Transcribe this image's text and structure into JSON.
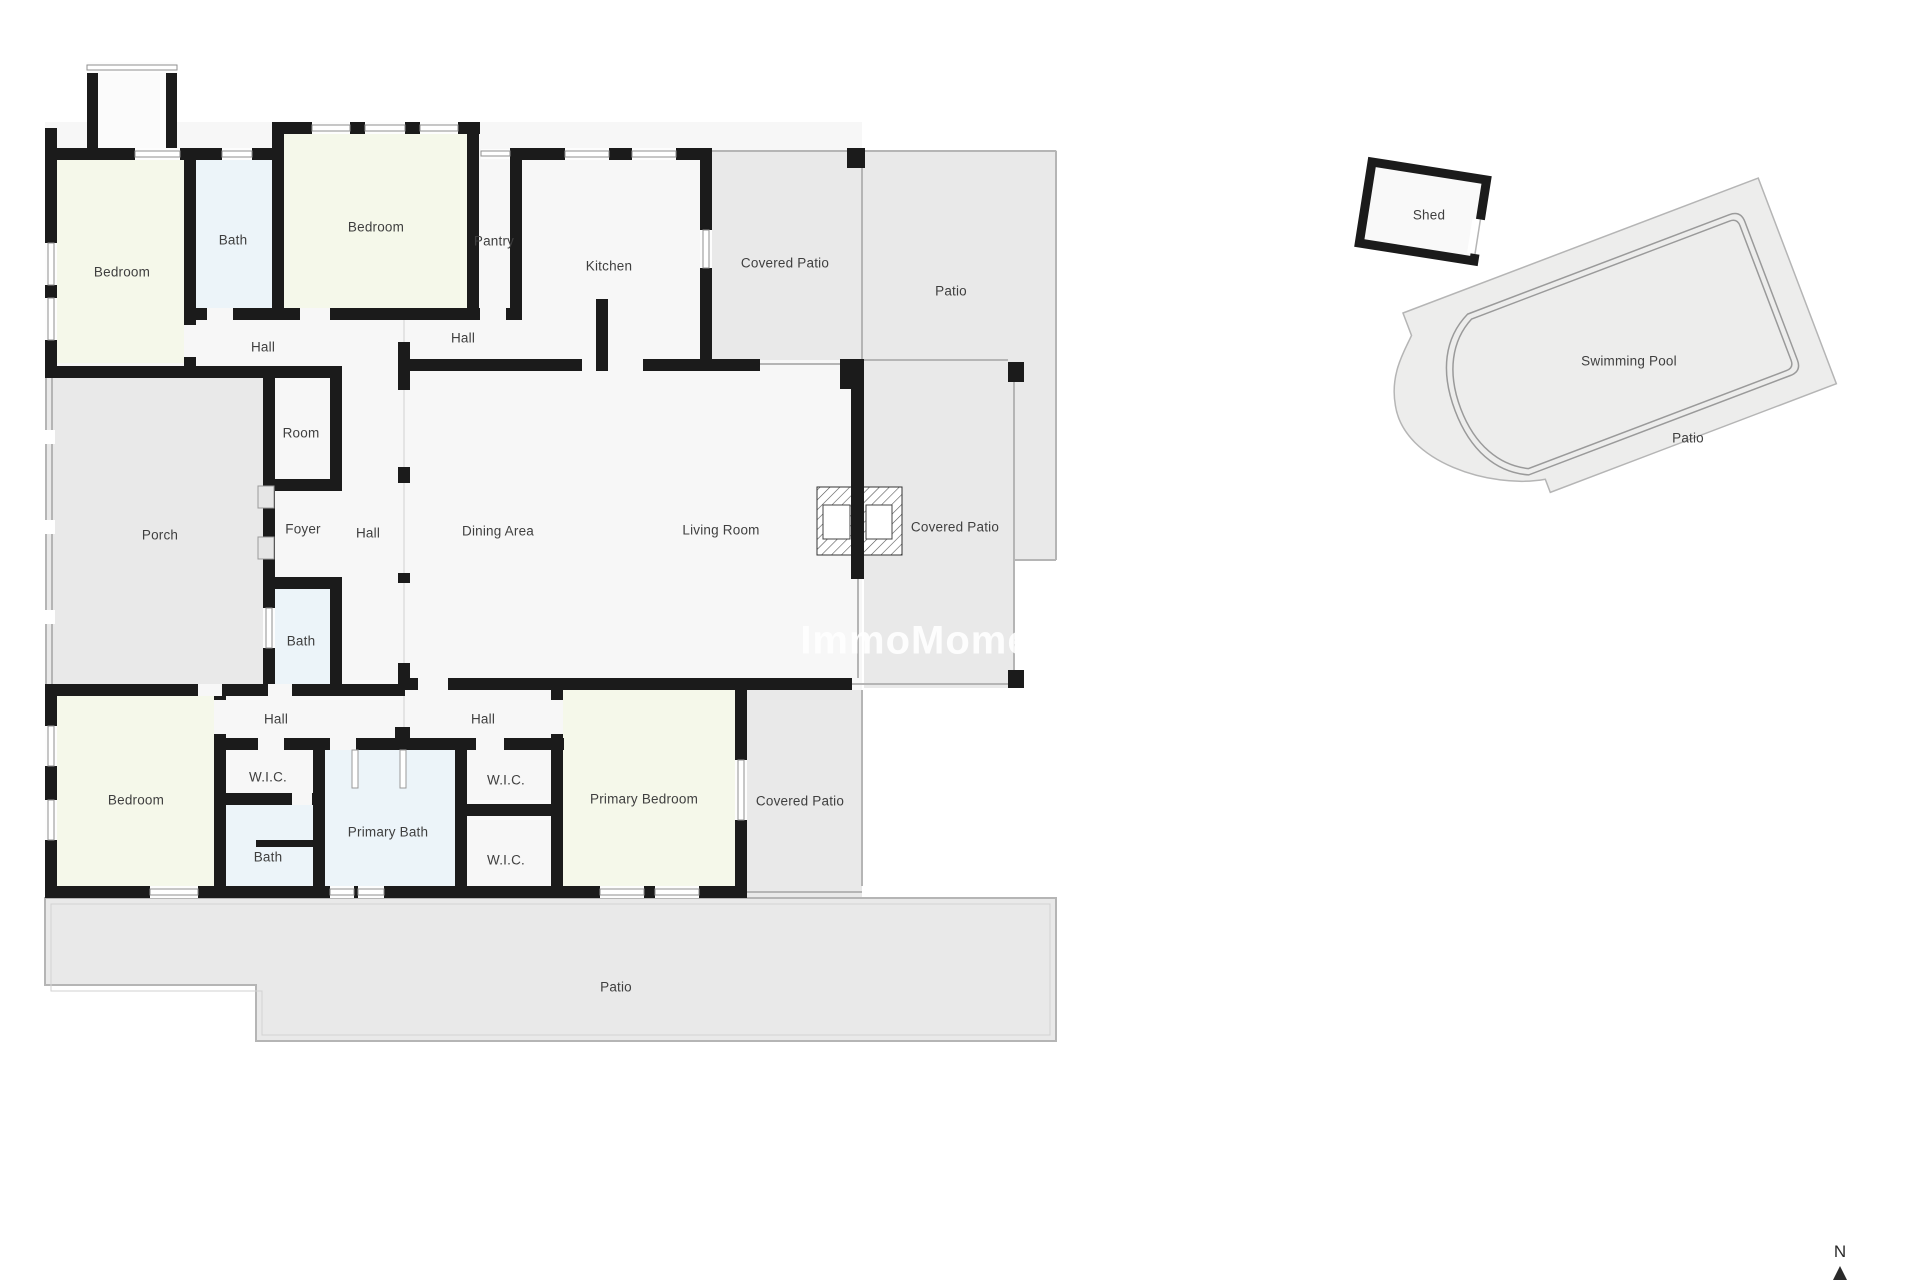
{
  "colors": {
    "wall": "#1b1b1b",
    "floor": "#f7f7f7",
    "patio": "#e9e9e9",
    "patio-light": "#ededec",
    "bedroom": "#f5f8ea",
    "bath": "#ecf4f9",
    "line": "#b5b5b5",
    "label": "#3f3f3f",
    "page-bg": "#ffffff"
  },
  "watermark": {
    "text": "ImmoMoment.e"
  },
  "compass": {
    "label": "N"
  },
  "floorplan": {
    "labels": [
      {
        "id": "bedroom-1",
        "text": "Bedroom",
        "x": 122,
        "y": 272
      },
      {
        "id": "bath-1",
        "text": "Bath",
        "x": 233,
        "y": 240
      },
      {
        "id": "bedroom-2",
        "text": "Bedroom",
        "x": 376,
        "y": 227
      },
      {
        "id": "pantry",
        "text": "Pantry",
        "x": 494,
        "y": 241
      },
      {
        "id": "kitchen",
        "text": "Kitchen",
        "x": 609,
        "y": 266
      },
      {
        "id": "covered-patio-top",
        "text": "Covered Patio",
        "x": 785,
        "y": 263
      },
      {
        "id": "patio-top",
        "text": "Patio",
        "x": 951,
        "y": 291
      },
      {
        "id": "hall-top-left",
        "text": "Hall",
        "x": 263,
        "y": 347
      },
      {
        "id": "hall-top-mid",
        "text": "Hall",
        "x": 463,
        "y": 338
      },
      {
        "id": "room",
        "text": "Room",
        "x": 301,
        "y": 433
      },
      {
        "id": "porch",
        "text": "Porch",
        "x": 160,
        "y": 535
      },
      {
        "id": "foyer",
        "text": "Foyer",
        "x": 303,
        "y": 529
      },
      {
        "id": "hall-center",
        "text": "Hall",
        "x": 368,
        "y": 533
      },
      {
        "id": "dining-area",
        "text": "Dining Area",
        "x": 498,
        "y": 531
      },
      {
        "id": "living-room",
        "text": "Living Room",
        "x": 721,
        "y": 530
      },
      {
        "id": "covered-patio-right",
        "text": "Covered Patio",
        "x": 955,
        "y": 527
      },
      {
        "id": "bath-center",
        "text": "Bath",
        "x": 301,
        "y": 641
      },
      {
        "id": "hall-bottom-left",
        "text": "Hall",
        "x": 276,
        "y": 719
      },
      {
        "id": "hall-bottom-mid",
        "text": "Hall",
        "x": 483,
        "y": 719
      },
      {
        "id": "bedroom-3",
        "text": "Bedroom",
        "x": 136,
        "y": 800
      },
      {
        "id": "wic-left",
        "text": "W.I.C.",
        "x": 268,
        "y": 777
      },
      {
        "id": "wic-mid-top",
        "text": "W.I.C.",
        "x": 506,
        "y": 780
      },
      {
        "id": "primary-bath",
        "text": "Primary Bath",
        "x": 388,
        "y": 832
      },
      {
        "id": "bath-bottom-left",
        "text": "Bath",
        "x": 268,
        "y": 857
      },
      {
        "id": "wic-mid-bottom",
        "text": "W.I.C.",
        "x": 506,
        "y": 860
      },
      {
        "id": "primary-bedroom",
        "text": "Primary Bedroom",
        "x": 644,
        "y": 799
      },
      {
        "id": "covered-patio-bottom",
        "text": "Covered Patio",
        "x": 800,
        "y": 801
      },
      {
        "id": "patio-bottom",
        "text": "Patio",
        "x": 616,
        "y": 987
      },
      {
        "id": "shed",
        "text": "Shed",
        "x": 1429,
        "y": 215
      },
      {
        "id": "swimming-pool",
        "text": "Swimming Pool",
        "x": 1629,
        "y": 361
      },
      {
        "id": "patio-pool",
        "text": "Patio",
        "x": 1688,
        "y": 438
      }
    ]
  }
}
